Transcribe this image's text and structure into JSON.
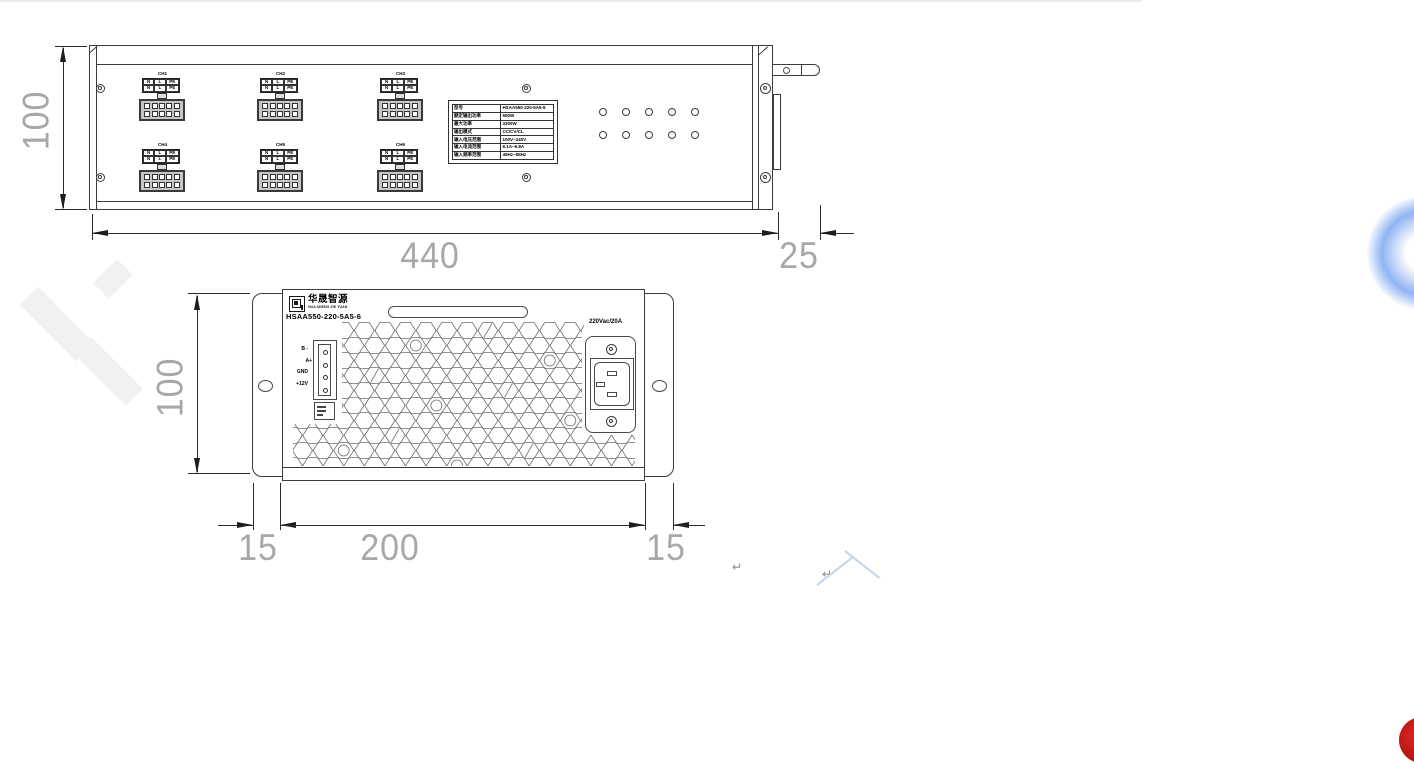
{
  "drawing": {
    "top_view": {
      "dim_length": "440",
      "dim_handle": "25",
      "dim_height": "100",
      "channels": [
        {
          "label": "CH1",
          "cells": [
            "N",
            "L",
            "PE",
            "N",
            "L",
            "PE"
          ]
        },
        {
          "label": "CH2",
          "cells": [
            "N",
            "L",
            "PE",
            "N",
            "L",
            "PE"
          ]
        },
        {
          "label": "CH3",
          "cells": [
            "N",
            "L",
            "PE",
            "N",
            "L",
            "PE"
          ]
        },
        {
          "label": "CH4",
          "cells": [
            "N",
            "L",
            "PE",
            "N",
            "L",
            "PE"
          ]
        },
        {
          "label": "CH5",
          "cells": [
            "N",
            "L",
            "PE",
            "N",
            "L",
            "PE"
          ]
        },
        {
          "label": "CH6",
          "cells": [
            "N",
            "L",
            "PE",
            "N",
            "L",
            "PE"
          ]
        }
      ],
      "spec_table": {
        "rows": [
          {
            "label": "型号",
            "value": "HSAA550-220-5A5-6"
          },
          {
            "label": "额定输出功率",
            "value": "550W"
          },
          {
            "label": "最大功率",
            "value": "3300W"
          },
          {
            "label": "输出模式",
            "value": "CC/CV/CL"
          },
          {
            "label": "输入电压范围",
            "value": "100V~240V"
          },
          {
            "label": "输入电流范围",
            "value": "6.1A~6.8A"
          },
          {
            "label": "输入频率范围",
            "value": "45Hz~65Hz"
          }
        ]
      }
    },
    "front_view": {
      "dim_height": "100",
      "dim_left_ear": "15",
      "dim_body": "200",
      "dim_right_ear": "15",
      "brand": {
        "cn": "华晟智源",
        "en": "HUA SHENG ZHI YUAN",
        "model": "HSAA550-220-5A5-6"
      },
      "power_rating": "220Vac/20A",
      "signal_labels": [
        "B -",
        "A+",
        "GND",
        "+12V"
      ]
    },
    "annotations": {
      "paragraph_mark": "↵"
    }
  },
  "floating": {
    "assistant_color": "#8fb4f3",
    "record_color": "#b50f0f"
  }
}
